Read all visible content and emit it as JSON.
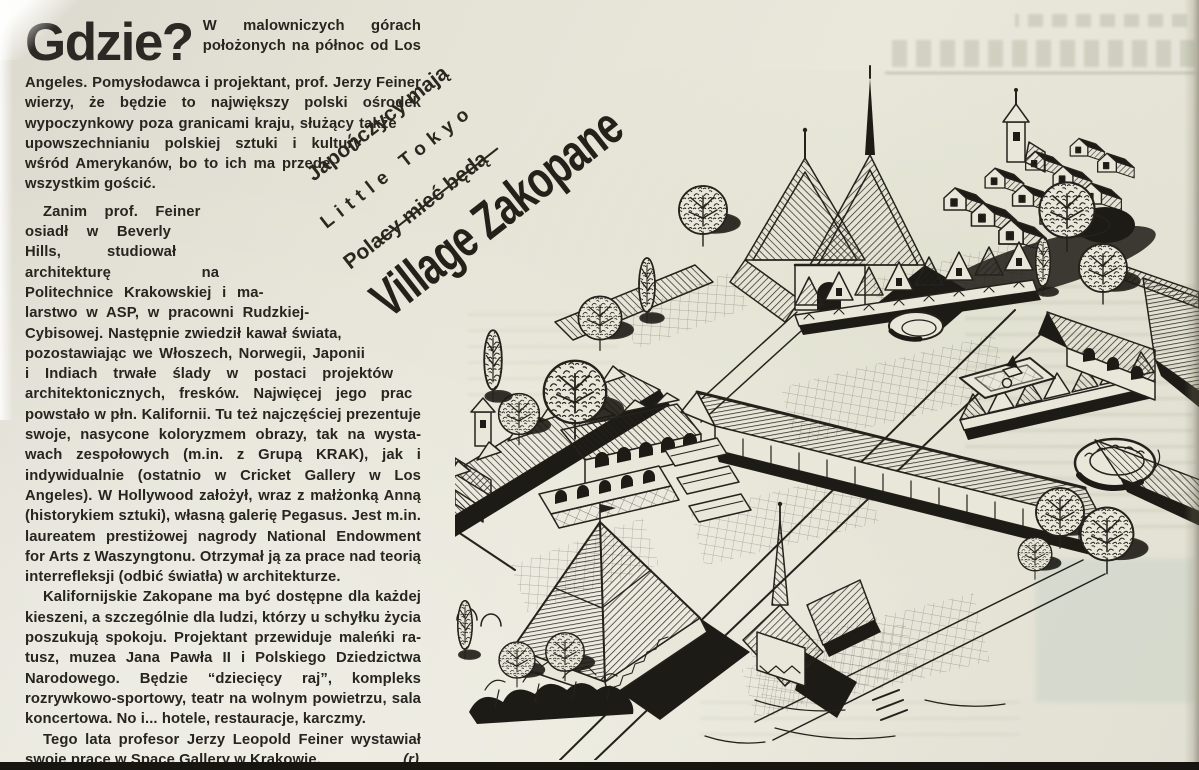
{
  "page": {
    "background": "#e7e5d8",
    "ink": "#24221c",
    "bottom_bar_color": "#17150f"
  },
  "article": {
    "headline": "Gdzie?",
    "paragraphs": [
      "W malowniczych górach położo­nych na północ od Los Angeles. Pomysłodawca i projektant, prof. Jerzy Feiner wierzy, że będzie to największy polski ośro­dek wypoczynkowy poza granicami kraju, służący także upowszechnianiu pol­skiej sztuki i kultury wśród Amery­kanów, bo to ich ma przede wszystkim gościć.",
      "Zanim prof. Feiner osiadł w Beverly Hills, studiował architek­turę na Politechnice Krakowskiej i ma­larstwo w ASP, w pracowni Rudzkiej-Cy­bisowej. Następnie zwiedził kawał świata, pozostawiając we Włoszech, Norwegii, Japo­nii i Indiach trwałe ślady w postaci projektów architektonicznych, fresków. Najwięcej jego prac powstało w płn. Kalifornii. Tu też najczęściej prezen­tuje swoje, nasycone koloryzmem obrazy, tak na wysta­wach zespołowych (m.in. z Grupą KRAK), jak i indywidu­alnie (ostatnio w Cricket Gallery w Los Angeles). W Hol­lywood założył, wraz z małżonką Anną (historykiem sztuki), własną galerię Pegasus. Jest m.in. laureatem prestiżowej nagrody National Endowment for Arts z Waszyngtonu. Otrzymał ją za prace nad teorią interre­fleksji (odbić światła) w architekturze.",
      "Kalifornijskie Zakopane ma być dostępne dla każdej kieszeni, a szczególnie dla ludzi, którzy u schyłku życia poszukują spokoju. Projektant przewiduje maleńki ra­tusz, muzea Jana Pawła II i Polskiego Dziedzictwa Naro­dowego. Będzie “dziecięcy raj”, kompleks rozrywkowo-sportowy, teatr na wolnym powietrzu, sala koncerto­wa. No i... hotele, restauracje, karczmy.",
      "Tego lata profesor Jerzy Leopold Feiner wystawiał swoje prace w Space Gallery w Krakowie."
    ],
    "signature": "(r)"
  },
  "rotated_headline": {
    "kicker_line1": "Japończycy mają",
    "kicker_line2": "Little Tokyo",
    "kicker_line3": "Polacy mieć będą",
    "title": "Village Zakopane"
  }
}
